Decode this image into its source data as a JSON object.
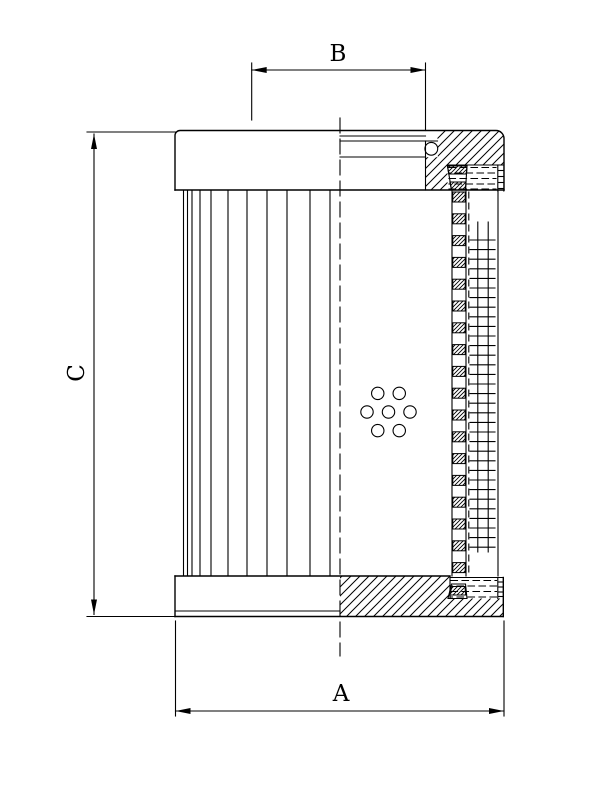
{
  "figure": {
    "background_color": "#ffffff",
    "line_color": "#000000",
    "dimension_labels": {
      "a": "A",
      "b": "B",
      "c": "C"
    }
  }
}
